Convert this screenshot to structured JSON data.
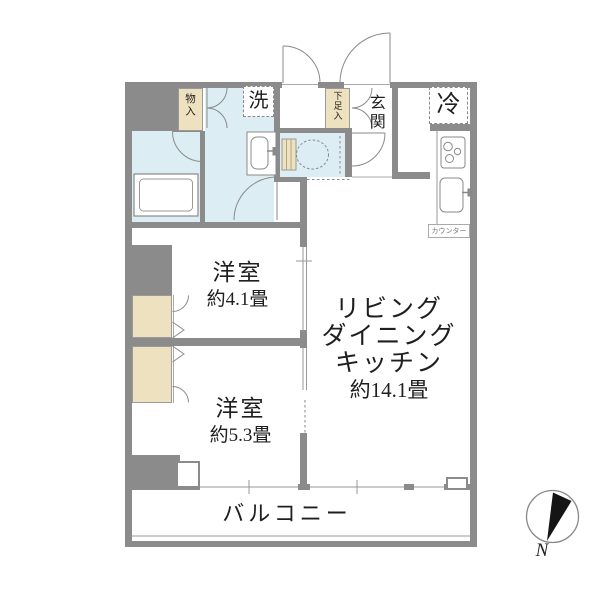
{
  "colors": {
    "wall": "#8b8b8b",
    "water": "#dcedf4",
    "closet": "#ede1bf",
    "line": "#999999",
    "text": "#1f1f1f"
  },
  "rooms": {
    "ldk": {
      "lines": [
        "リビング",
        "ダイニング",
        "キッチン"
      ],
      "size": "約14.1畳"
    },
    "bedroom_small": {
      "name": "洋室",
      "size": "約4.1畳"
    },
    "bedroom_large": {
      "name": "洋室",
      "size": "約5.3畳"
    },
    "balcony": {
      "name": "バルコニー"
    },
    "entrance": {
      "name": "玄関"
    }
  },
  "fixtures": {
    "storage": "物入",
    "washer": "洗",
    "shoe_cabinet": "下足入",
    "refrigerator": "冷",
    "counter": "カウンター"
  },
  "compass": {
    "north": "N"
  }
}
